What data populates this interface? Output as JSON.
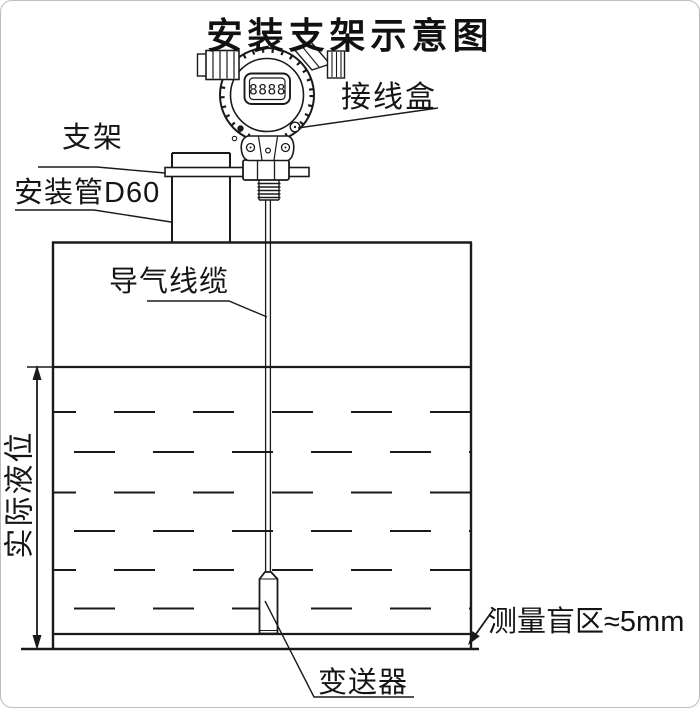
{
  "title": "安装支架示意图",
  "device": {
    "display_digits": "8888"
  },
  "labels": {
    "junction_box": "接线盒",
    "bracket": "支架",
    "mounting_pipe": "安装管D60",
    "air_cable": "导气线缆",
    "actual_level": "实际液位",
    "blind_zone": "测量盲区≈5mm",
    "transmitter": "变送器"
  },
  "colors": {
    "line": "#1a1a1a",
    "background": "#ffffff"
  }
}
